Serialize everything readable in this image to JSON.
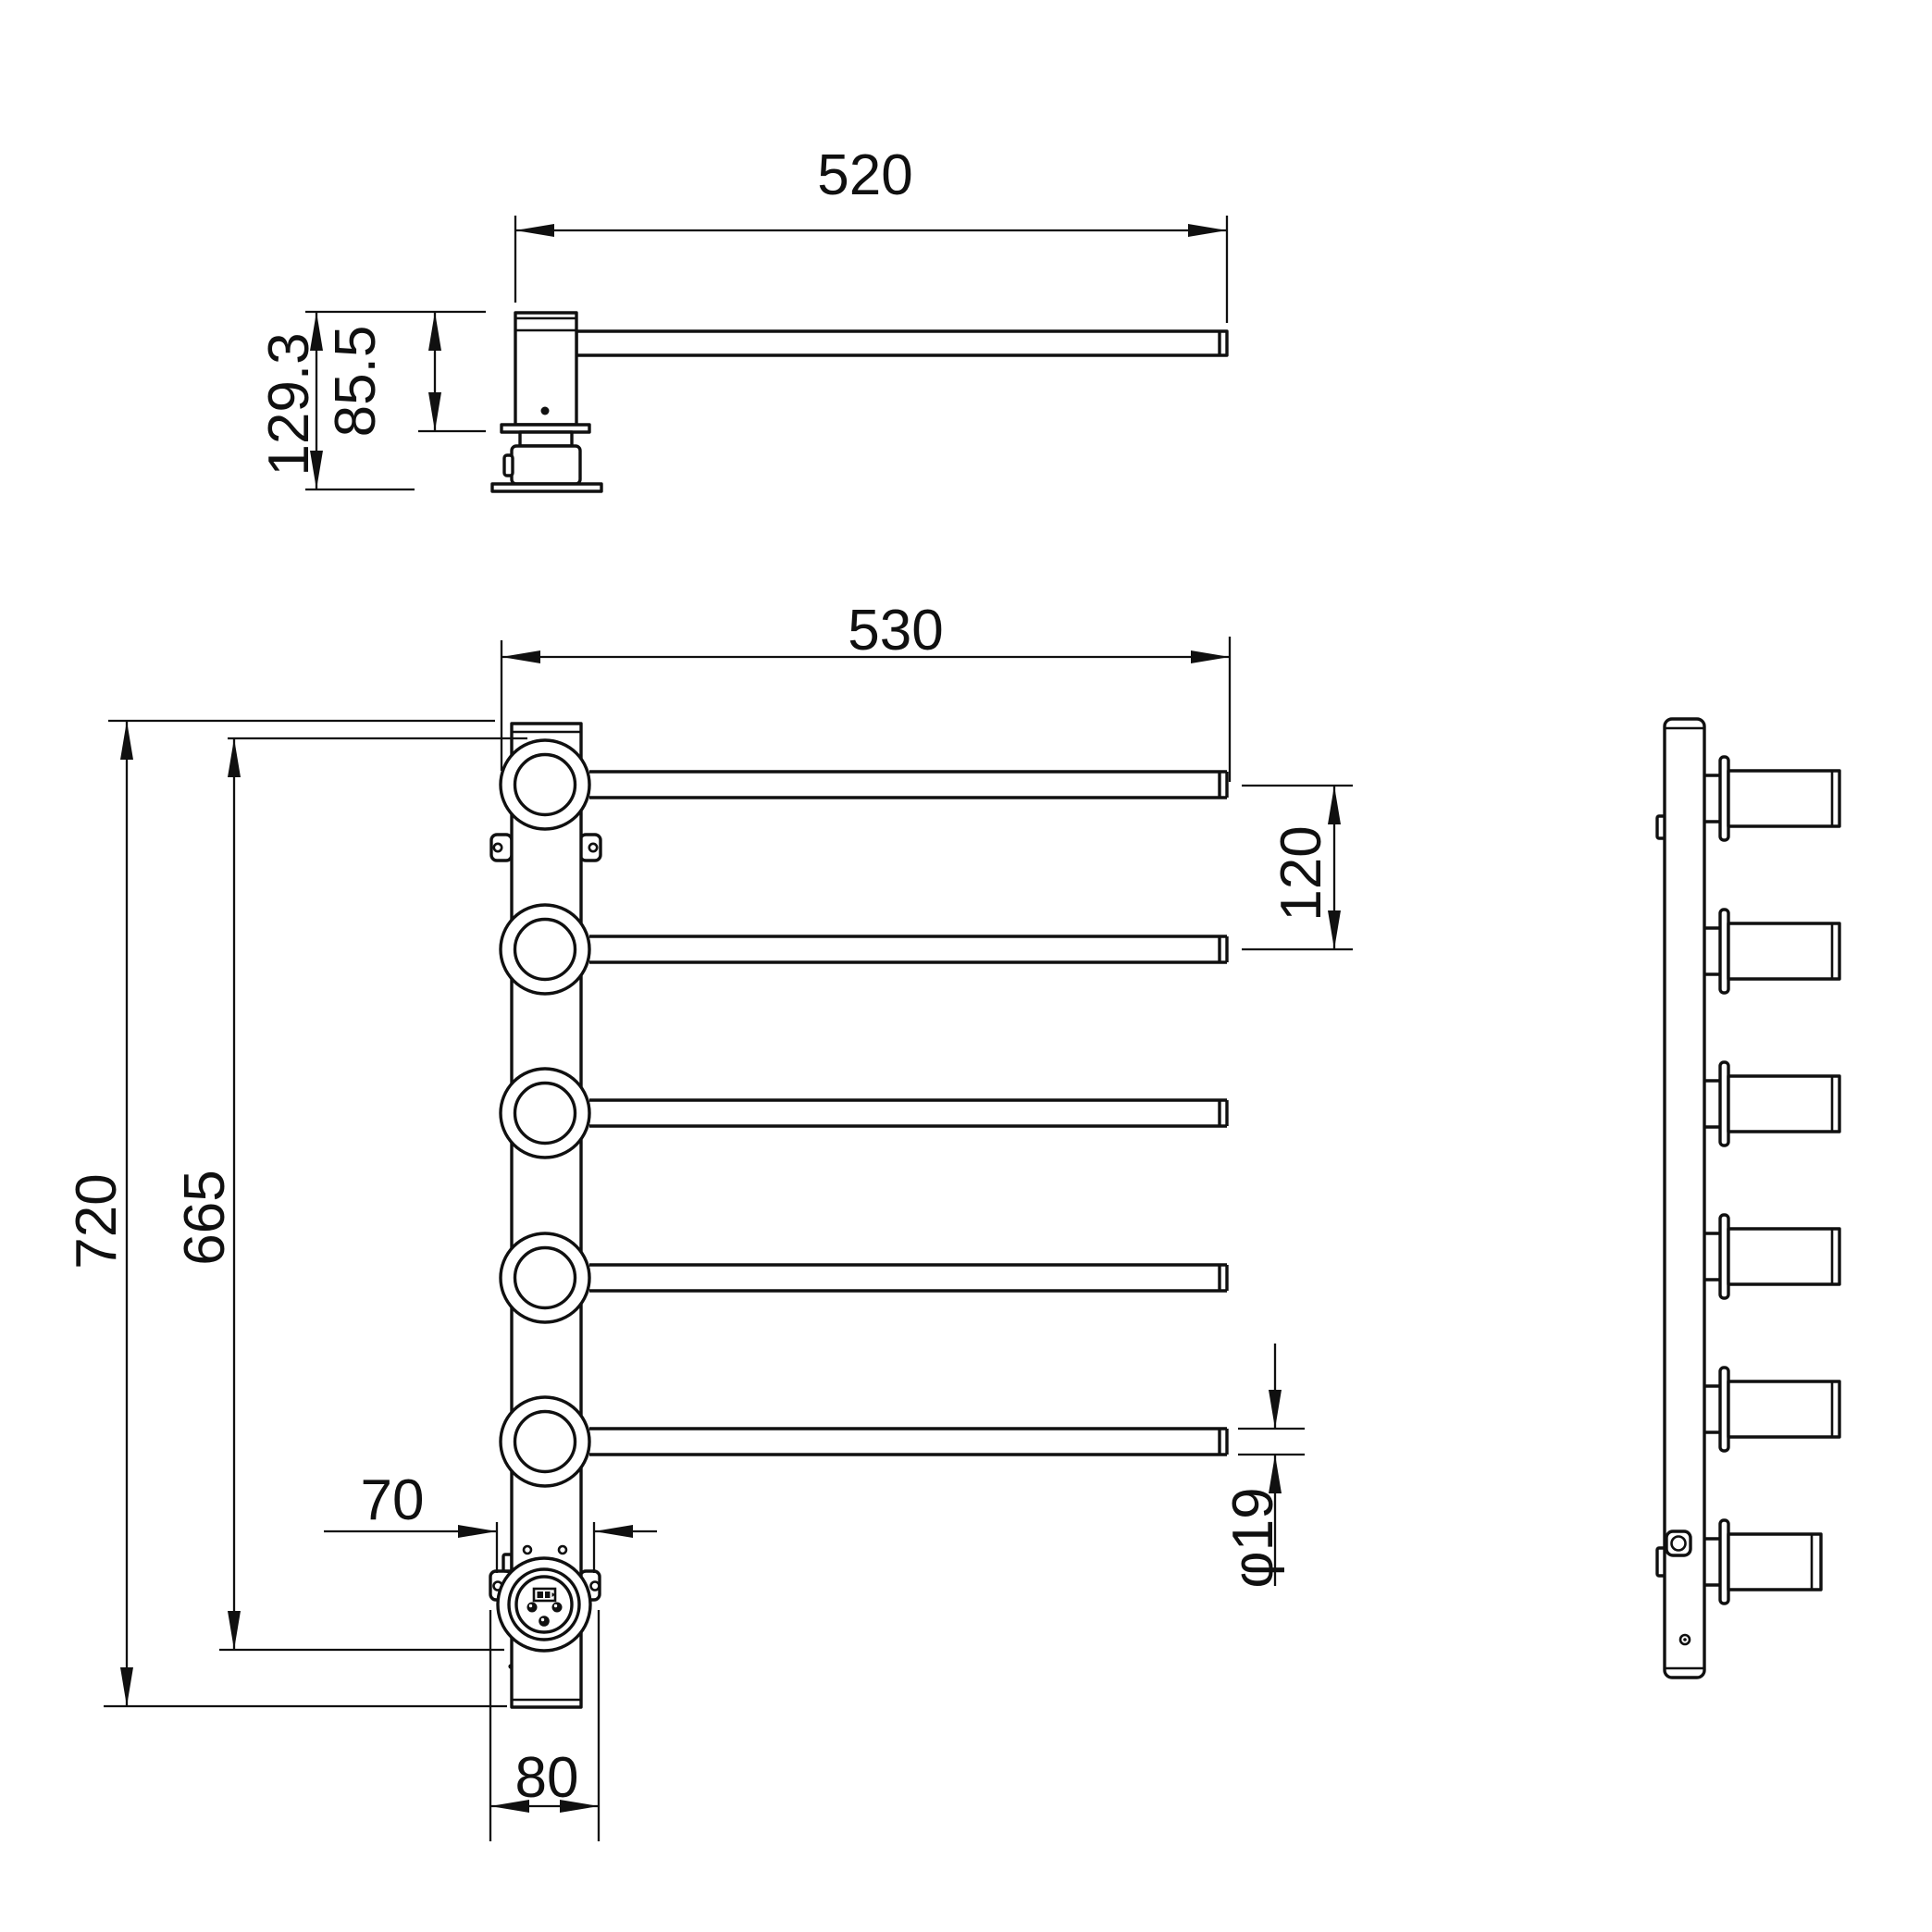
{
  "colors": {
    "background": "#ffffff",
    "line_color": "#101010"
  },
  "top_view": {
    "dims": {
      "arm_length": "520",
      "overall_depth": "129.3",
      "body_depth": "85.5"
    }
  },
  "front_view": {
    "dims": {
      "bar_length": "530",
      "overall_height": "720",
      "rail_span": "665",
      "bar_pitch": "120",
      "bar_diameter": "φ19",
      "socket_hole_spacing": "70",
      "base_width": "80"
    }
  }
}
